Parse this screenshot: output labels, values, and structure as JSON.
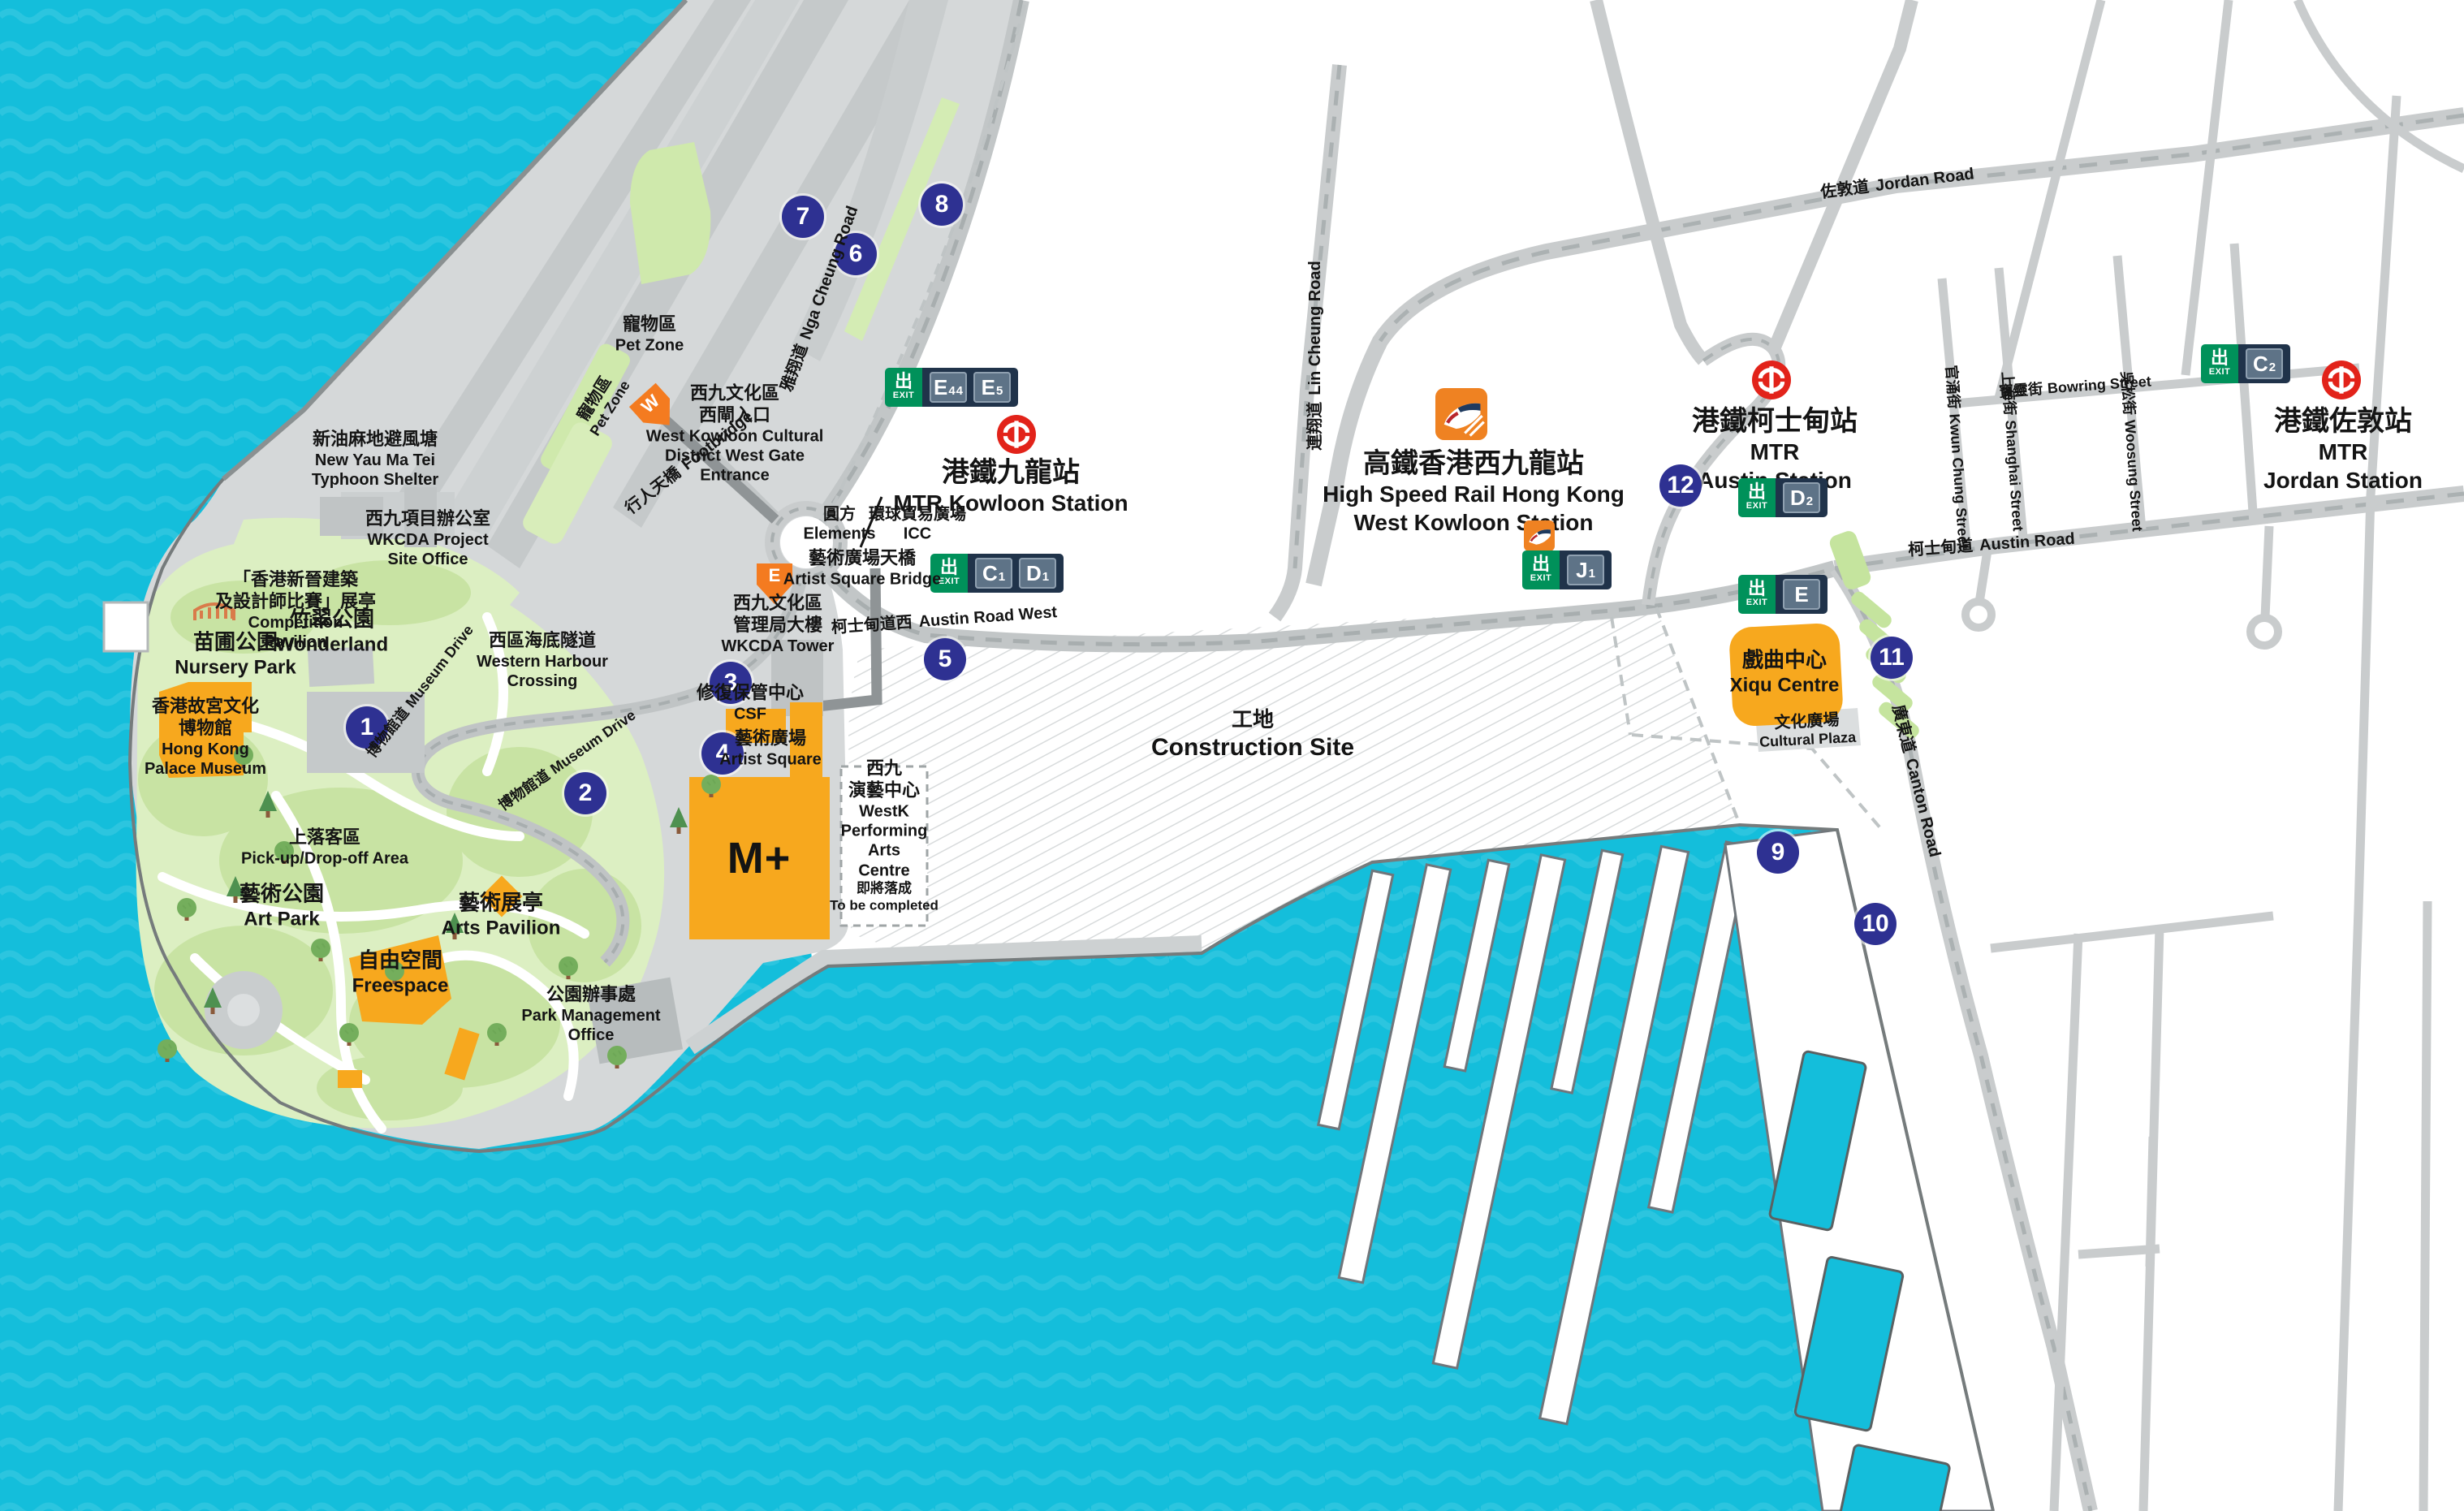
{
  "title": "West Kowloon Cultural District map",
  "colors": {
    "sea": "#14BEDB",
    "sea_wave": "#3FCBE3",
    "land": "#FFFFFF",
    "peninsula_gray": "#D5D8D9",
    "road_gray": "#C9CCCD",
    "road_dash": "#ABB1B2",
    "footbridge_gray": "#8F9496",
    "park_green": "#DCEFC2",
    "park_patch": "#C8E3A3",
    "building_orange": "#F7A81E",
    "entrance_orange": "#F47B20",
    "hsr_orange": "#EF8222",
    "marker_navy": "#2E3192",
    "exit_green": "#00915A",
    "exit_navy": "#20334A",
    "exit_tile": "#5E7387",
    "mtr_red": "#E2231A",
    "building_gray": "#C0C4C5"
  },
  "exit": {
    "zh": "出",
    "en": "EXIT"
  },
  "exit_badges": {
    "e4e5": {
      "codes": [
        {
          "l": "E",
          "n": "4"
        },
        {
          "l": "E",
          "n": "5"
        }
      ]
    },
    "c1d1": {
      "codes": [
        {
          "l": "C",
          "n": "1"
        },
        {
          "l": "D",
          "n": "1"
        }
      ]
    },
    "j1": {
      "codes": [
        {
          "l": "J",
          "n": "1"
        }
      ]
    },
    "d2": {
      "codes": [
        {
          "l": "D",
          "n": "2"
        }
      ]
    },
    "e": {
      "codes": [
        {
          "l": "E",
          "n": ""
        }
      ]
    },
    "c2": {
      "codes": [
        {
          "l": "C",
          "n": "2"
        }
      ]
    }
  },
  "markers": [
    "1",
    "2",
    "3",
    "4",
    "5",
    "6",
    "7",
    "8",
    "9",
    "10",
    "11",
    "12"
  ],
  "entrances": {
    "west": "W",
    "east": "E"
  },
  "stations": {
    "kowloon": {
      "zh": "港鐵九龍站",
      "en": "MTR Kowloon Station"
    },
    "hsr": {
      "zh": "高鐵香港西九龍站",
      "en1": "High Speed Rail Hong Kong",
      "en2": "West Kowloon Station"
    },
    "austin": {
      "zh": "港鐵柯士甸站",
      "en1": "MTR",
      "en2": "Austin Station"
    },
    "jordan": {
      "zh": "港鐵佐敦站",
      "en1": "MTR",
      "en2": "Jordan Station"
    }
  },
  "places": {
    "typhoon": {
      "zh": "新油麻地避風塘",
      "en1": "New Yau Ma Tei",
      "en2": "Typhoon Shelter"
    },
    "petzone": {
      "zh": "寵物區",
      "en": "Pet Zone"
    },
    "westgate": {
      "zh1": "西九文化區",
      "zh2": "西閘入口",
      "en1": "West Kowloon Cultural",
      "en2": "District West Gate",
      "en3": "Entrance"
    },
    "footbridge": {
      "zh": "行人天橋",
      "en": "Footbridge"
    },
    "wkcda_office": {
      "zh": "西九項目辦公室",
      "en1": "WKCDA Project",
      "en2": "Site Office"
    },
    "competition": {
      "zh1": "「香港新晉建築",
      "zh2": "及設計師比賽」展亭",
      "en1": "Competition",
      "en2": "Pavilion"
    },
    "wonderland": {
      "zh": "竹翠公園",
      "en": "Wonderland"
    },
    "nursery": {
      "zh": "苗圃公園",
      "en": "Nursery Park"
    },
    "palace": {
      "zh1": "香港故宮文化",
      "zh2": "博物館",
      "en1": "Hong Kong",
      "en2": "Palace Museum"
    },
    "whc": {
      "zh": "西區海底隧道",
      "en1": "Western Harbour",
      "en2": "Crossing"
    },
    "pickup": {
      "zh": "上落客區",
      "en": "Pick-up/Drop-off Area"
    },
    "artpark": {
      "zh": "藝術公園",
      "en": "Art Park"
    },
    "artspavilion": {
      "zh": "藝術展亭",
      "en": "Arts Pavilion"
    },
    "freespace": {
      "zh": "自由空間",
      "en": "Freespace"
    },
    "parkmgmt": {
      "zh": "公園辦事處",
      "en1": "Park Management",
      "en2": "Office"
    },
    "wkcdatower": {
      "zh1": "西九文化區",
      "zh2": "管理局大樓",
      "en": "WKCDA Tower"
    },
    "csf": {
      "zh": "修復保管中心",
      "en": "CSF"
    },
    "artistsq": {
      "zh": "藝術廣場",
      "en": "Artist Square"
    },
    "mplus": {
      "en": "M+"
    },
    "westkpac": {
      "zh1": "西九",
      "zh2": "演藝中心",
      "en1": "WestK",
      "en2": "Performing",
      "en3": "Arts",
      "en4": "Centre",
      "note_zh": "即將落成",
      "note_en": "To be completed"
    },
    "construction": {
      "zh": "工地",
      "en": "Construction Site"
    },
    "elements": {
      "zh": "圓方",
      "en": "Elements"
    },
    "icc": {
      "zh": "環球貿易廣場",
      "en": "ICC"
    },
    "asbridge": {
      "zh": "藝術廣場天橋",
      "en": "Artist Square Bridge"
    },
    "xiqu": {
      "zh": "戲曲中心",
      "en": "Xiqu Centre"
    },
    "culturalplaza": {
      "zh": "文化廣場",
      "en": "Cultural Plaza"
    }
  },
  "roads": {
    "ngacheung": {
      "zh": "雅翔道",
      "en": "Nga Cheung Road"
    },
    "lincheung": {
      "zh": "連翔道",
      "en": "Lin Cheung Road"
    },
    "jordan": {
      "zh": "佐敦道",
      "en": "Jordan Road"
    },
    "austinw": {
      "zh": "柯士甸道西",
      "en": "Austin Road West"
    },
    "austin": {
      "zh": "柯士甸道",
      "en": "Austin Road"
    },
    "canton": {
      "zh": "廣東道",
      "en": "Canton Road"
    },
    "bowring": {
      "zh": "寶靈街",
      "en": "Bowring Street"
    },
    "kwunchung": {
      "zh": "官涌街",
      "en": "Kwun Chung Street"
    },
    "shanghai": {
      "zh": "上海街",
      "en": "Shanghai Street"
    },
    "woosung": {
      "zh": "吳松街",
      "en": "Woosung Street"
    },
    "museumdrive": {
      "zh": "博物館道",
      "en": "Museum Drive"
    }
  }
}
